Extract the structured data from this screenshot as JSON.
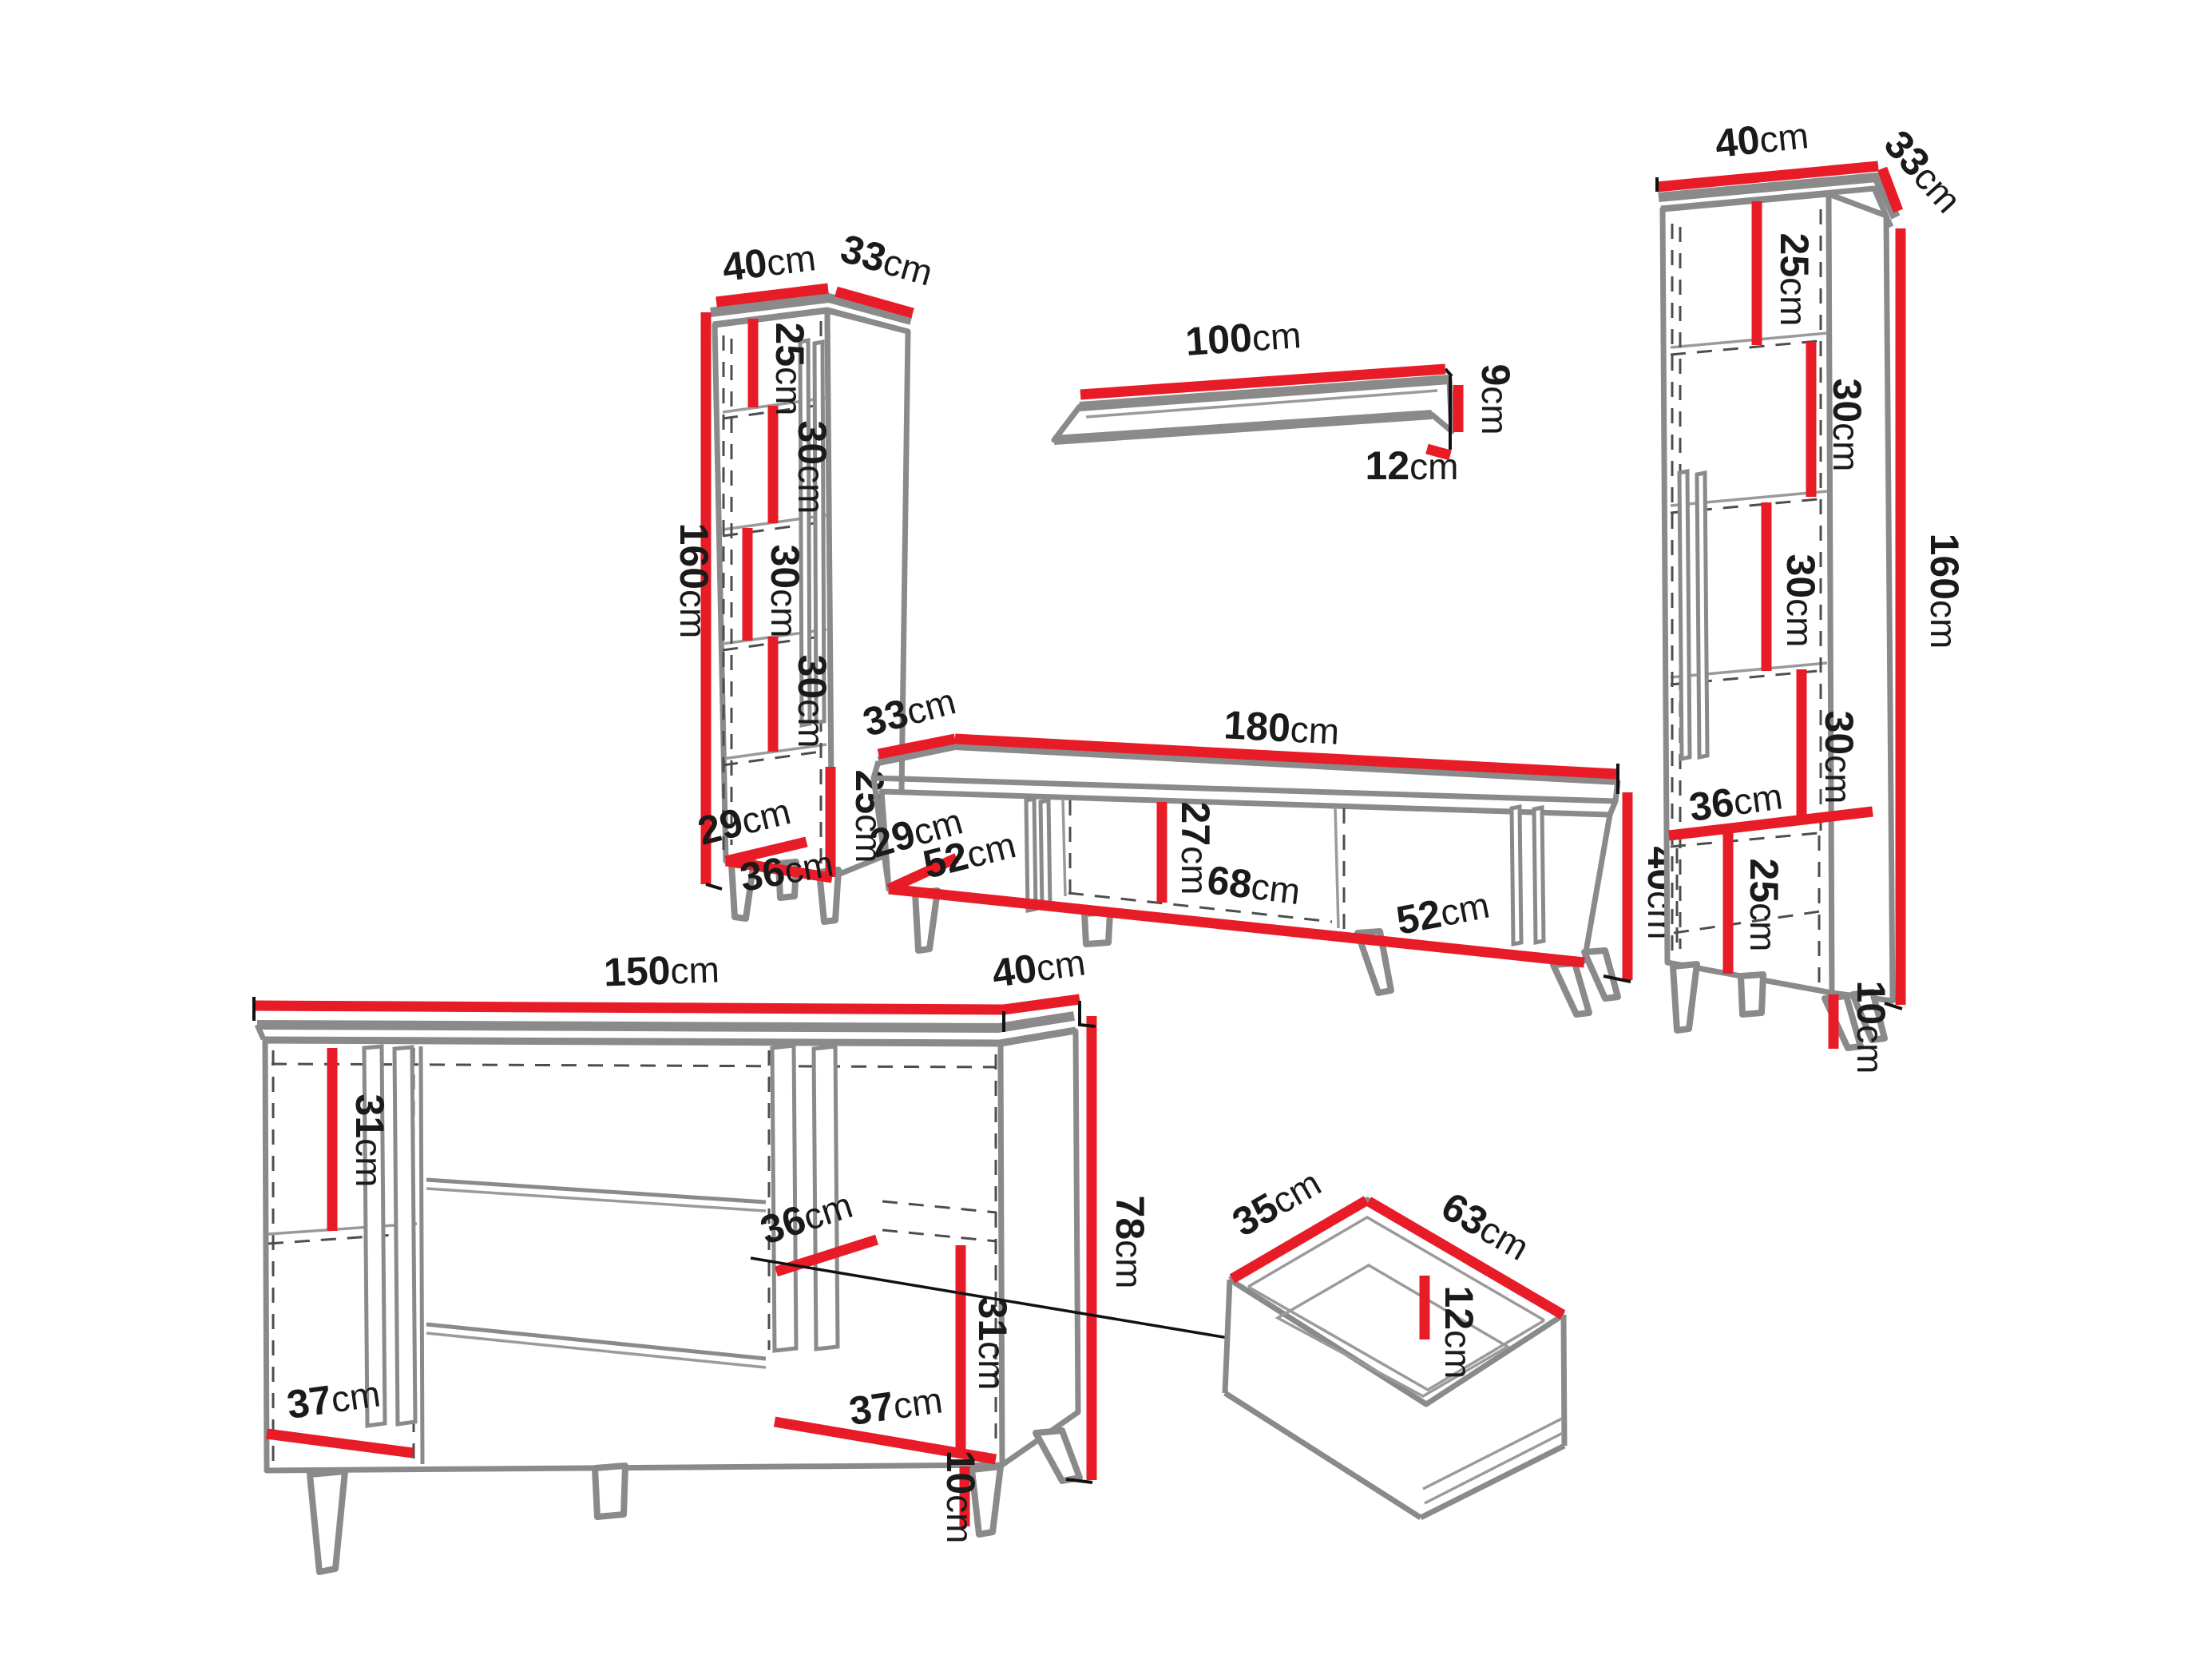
{
  "units": "cm",
  "colors": {
    "dimension": "#e81c26",
    "outline": "#8a8a8a",
    "text": "#1a1a1a",
    "background": "#ffffff"
  },
  "cabinet_left": {
    "width": "40",
    "depth": "33",
    "height": "160",
    "sections": [
      "25",
      "30",
      "30",
      "30"
    ],
    "bottom_section": "25",
    "base_depth": "29",
    "base_width": "36"
  },
  "wall_shelf": {
    "length": "100",
    "height": "9",
    "depth": "12"
  },
  "tv_stand": {
    "depth": "33",
    "length": "180",
    "base_depth": "29",
    "left_door": "52",
    "inner_height": "27",
    "middle_width": "68",
    "right_door": "52",
    "height": "40"
  },
  "cabinet_right": {
    "width": "40",
    "depth": "33",
    "height": "160",
    "sections": [
      "25",
      "30",
      "30",
      "30"
    ],
    "shelf_width": "36",
    "bottom_section": "25",
    "leg_height": "10"
  },
  "sideboard": {
    "length": "150",
    "depth": "40",
    "height": "78",
    "left_inner_height": "31",
    "shelf_depth": "36",
    "right_inner_height": "31",
    "left_door_width": "37",
    "right_door_width": "37",
    "leg_height": "10"
  },
  "drawer": {
    "depth": "35",
    "width": "63",
    "inner_height": "12"
  }
}
